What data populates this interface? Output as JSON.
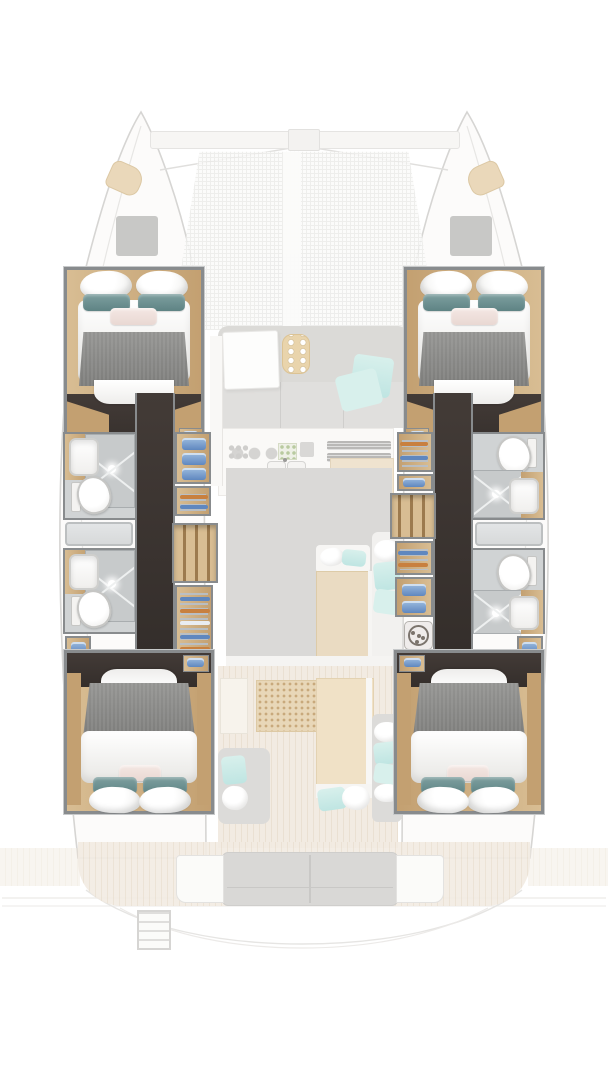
{
  "plan": {
    "vessel_type": "catamaran",
    "view": "top-down deck and accommodation plan",
    "bow": "top",
    "stern": "bottom"
  },
  "inventory": {
    "double_cabins": 4,
    "bathrooms": 4,
    "showers": 4,
    "toilets": 4,
    "washbasins": 5,
    "wardrobe_racks": 4,
    "towel_shelves": 4,
    "staircases": 2,
    "washing_machines": 1,
    "trampoline": 1,
    "forward_lounge": 1,
    "galley": 1,
    "saloon": 1,
    "cockpit_table": 1,
    "aft_bench": 1,
    "swim_ladder": 1
  },
  "icons": {
    "washing_machine_icon": "drum circle with dots",
    "toilet_icon": "oval bowl with cistern",
    "shower_icon": "square tray with X drain lines",
    "sink_icon": "rounded white basin",
    "hanger_rack_icon": "stacked hanger bars",
    "towel_stack_icon": "folded blue towels",
    "stairs_icon": "parallel wood treads",
    "burners_icon": "rings and knobs row",
    "trampoline_icon": "fine net grid"
  },
  "colors": {
    "wall": "#888b8d",
    "wall_light": "#c7c9ca",
    "wood": "#d8bd93",
    "wood_dark": "#c3a071",
    "wood_deep": "#9c7a4e",
    "floor_dark": "#433b37",
    "floor_dark2": "#342e2b",
    "bed_shadow": "#e8e7e4",
    "blanket_grey": "#949492",
    "blanket_grey2": "#7d7d7b",
    "pillow_teal": "#5e8384",
    "pillow_teal2": "#7fa0a0",
    "pillow_pink": "#e9d8d3",
    "towel_blue": "#9cbbde",
    "towel_blue_dark": "#5f87bf",
    "hanger_orange": "#c8803f",
    "hanger_steel": "#b7c0ca",
    "bath_bg": "#d0d3d4",
    "shower_grey": "#c7cacb",
    "shower_line": "#eef0f0",
    "window_grey": "#d7d9da",
    "ghost_grey": "#dbdad7",
    "ghost_white": "#f7f6f4",
    "ghost_wood": "#efe3cf",
    "ghost_deck": "#f2ebe2",
    "ghost_deck2": "#eae0d2",
    "ghost_aqua": "#bfe5e2",
    "ghost_aqua2": "#d8f0ec",
    "hull_line": "#d6d5d3",
    "hull_fill": "#fcfbfa",
    "net_line": "#ebebe9",
    "mat_tan": "#e8d7b8",
    "mat_dot": "#c8a97c"
  }
}
